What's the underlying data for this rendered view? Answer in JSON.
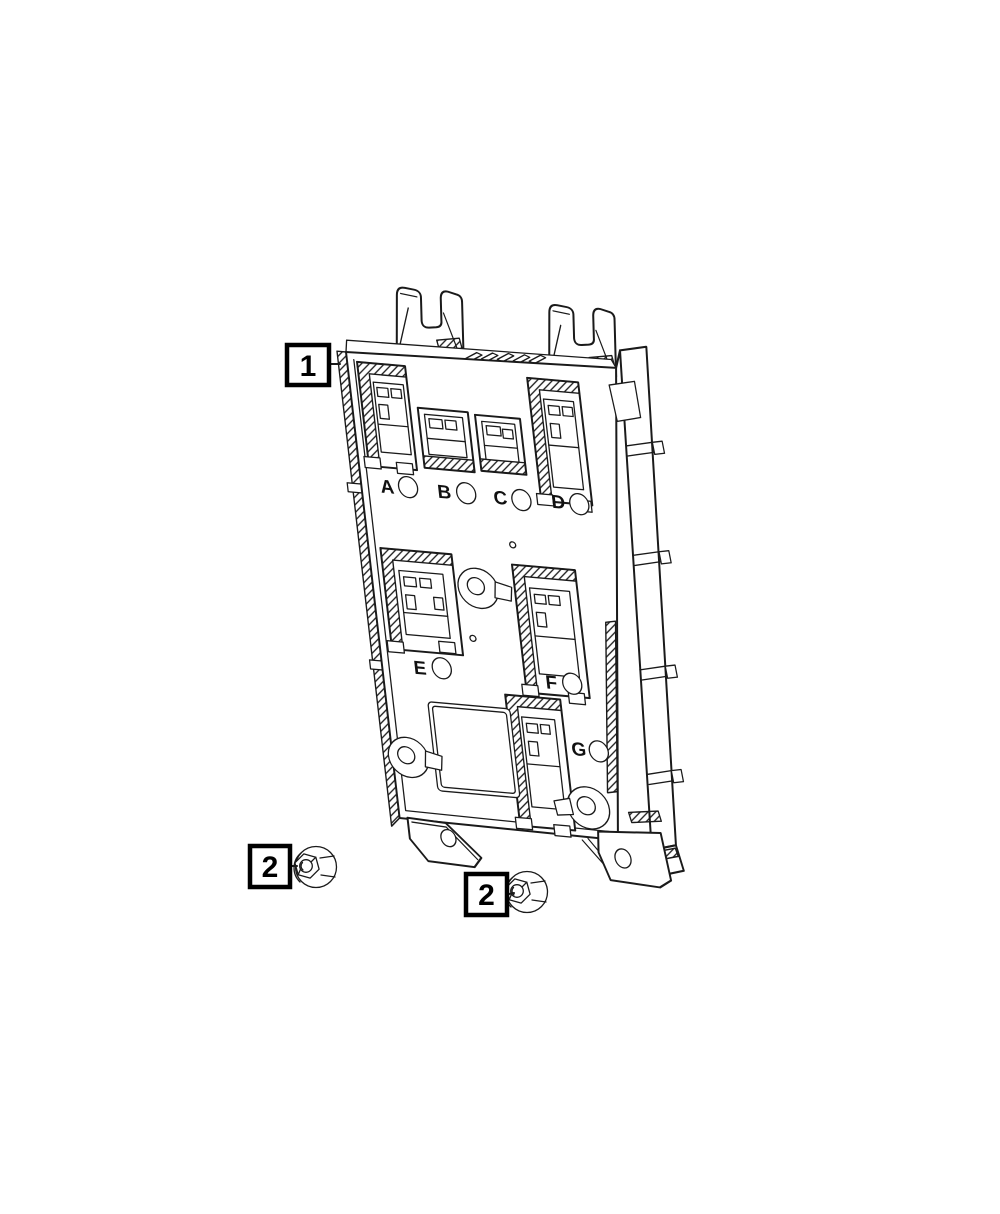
{
  "illustration": {
    "background": "#ffffff",
    "ink": "#1a1a1a",
    "callouts": [
      {
        "label": "1"
      },
      {
        "label": "2"
      },
      {
        "label": "2"
      }
    ],
    "connector_labels": [
      {
        "label": "A"
      },
      {
        "label": "B"
      },
      {
        "label": "C"
      },
      {
        "label": "D"
      },
      {
        "label": "E"
      },
      {
        "label": "F"
      },
      {
        "label": "G"
      }
    ]
  }
}
